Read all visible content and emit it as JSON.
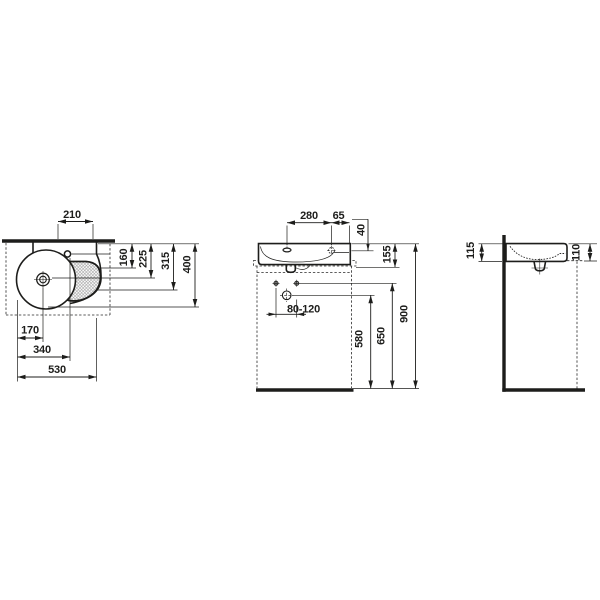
{
  "drawing": {
    "background": "#ffffff",
    "line_color": "#1d1d1b",
    "hatch_color": "#999999",
    "views": {
      "top": {
        "dims": {
          "tap_width": "210",
          "shelf_depth": "160",
          "drain_depth": "225",
          "basin_depth": "315",
          "total_depth": "400",
          "drain_offset": "170",
          "tap_offset": "340",
          "total_width": "530"
        }
      },
      "front": {
        "dims": {
          "hole_spacing": "280",
          "hole_to_edge": "65",
          "rim_to_hole": "40",
          "body_height": "155",
          "fixing_range": "80-120",
          "outlet_height": "580",
          "fixing_height": "650",
          "rim_height": "900"
        }
      },
      "side": {
        "dims": {
          "back_height": "115",
          "front_height": "110"
        }
      }
    }
  }
}
